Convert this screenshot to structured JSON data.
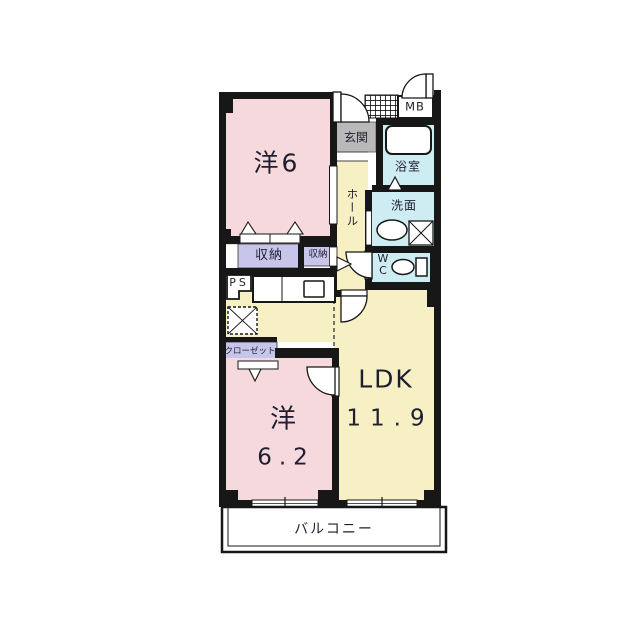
{
  "plan": {
    "type": "apartment-floor-plan",
    "labels": {
      "room1": "洋6",
      "room2_name": "洋",
      "room2_size": "6.2",
      "ldk_name": "LDK",
      "ldk_size": "11.9",
      "hall": "ホール",
      "entrance": "玄関",
      "bathroom": "浴室",
      "washroom": "洗面",
      "toilet": "WC",
      "storage_large": "収納",
      "storage_small": "収納",
      "closet": "クローゼット",
      "pipe_space": "PS",
      "meter_box": "MB",
      "balcony": "バルコニー"
    },
    "fixtures": [
      "bathtub",
      "washbasin",
      "toilet",
      "washing-machine-space",
      "kitchen-counter",
      "kitchen-sink",
      "refrigerator-space",
      "entrance-tile",
      "sliding-closet-doors",
      "door-swing-arcs",
      "balcony-windows"
    ],
    "colors": {
      "room_pink": "#f6d9dd",
      "living_yellow": "#f7f0c5",
      "storage_lavender": "#c7c6ea",
      "water_cyan": "#cdedf3",
      "genkan_gray": "#b9b9b9",
      "wall_black": "#171717",
      "text_dark": "#1e1e30"
    }
  }
}
